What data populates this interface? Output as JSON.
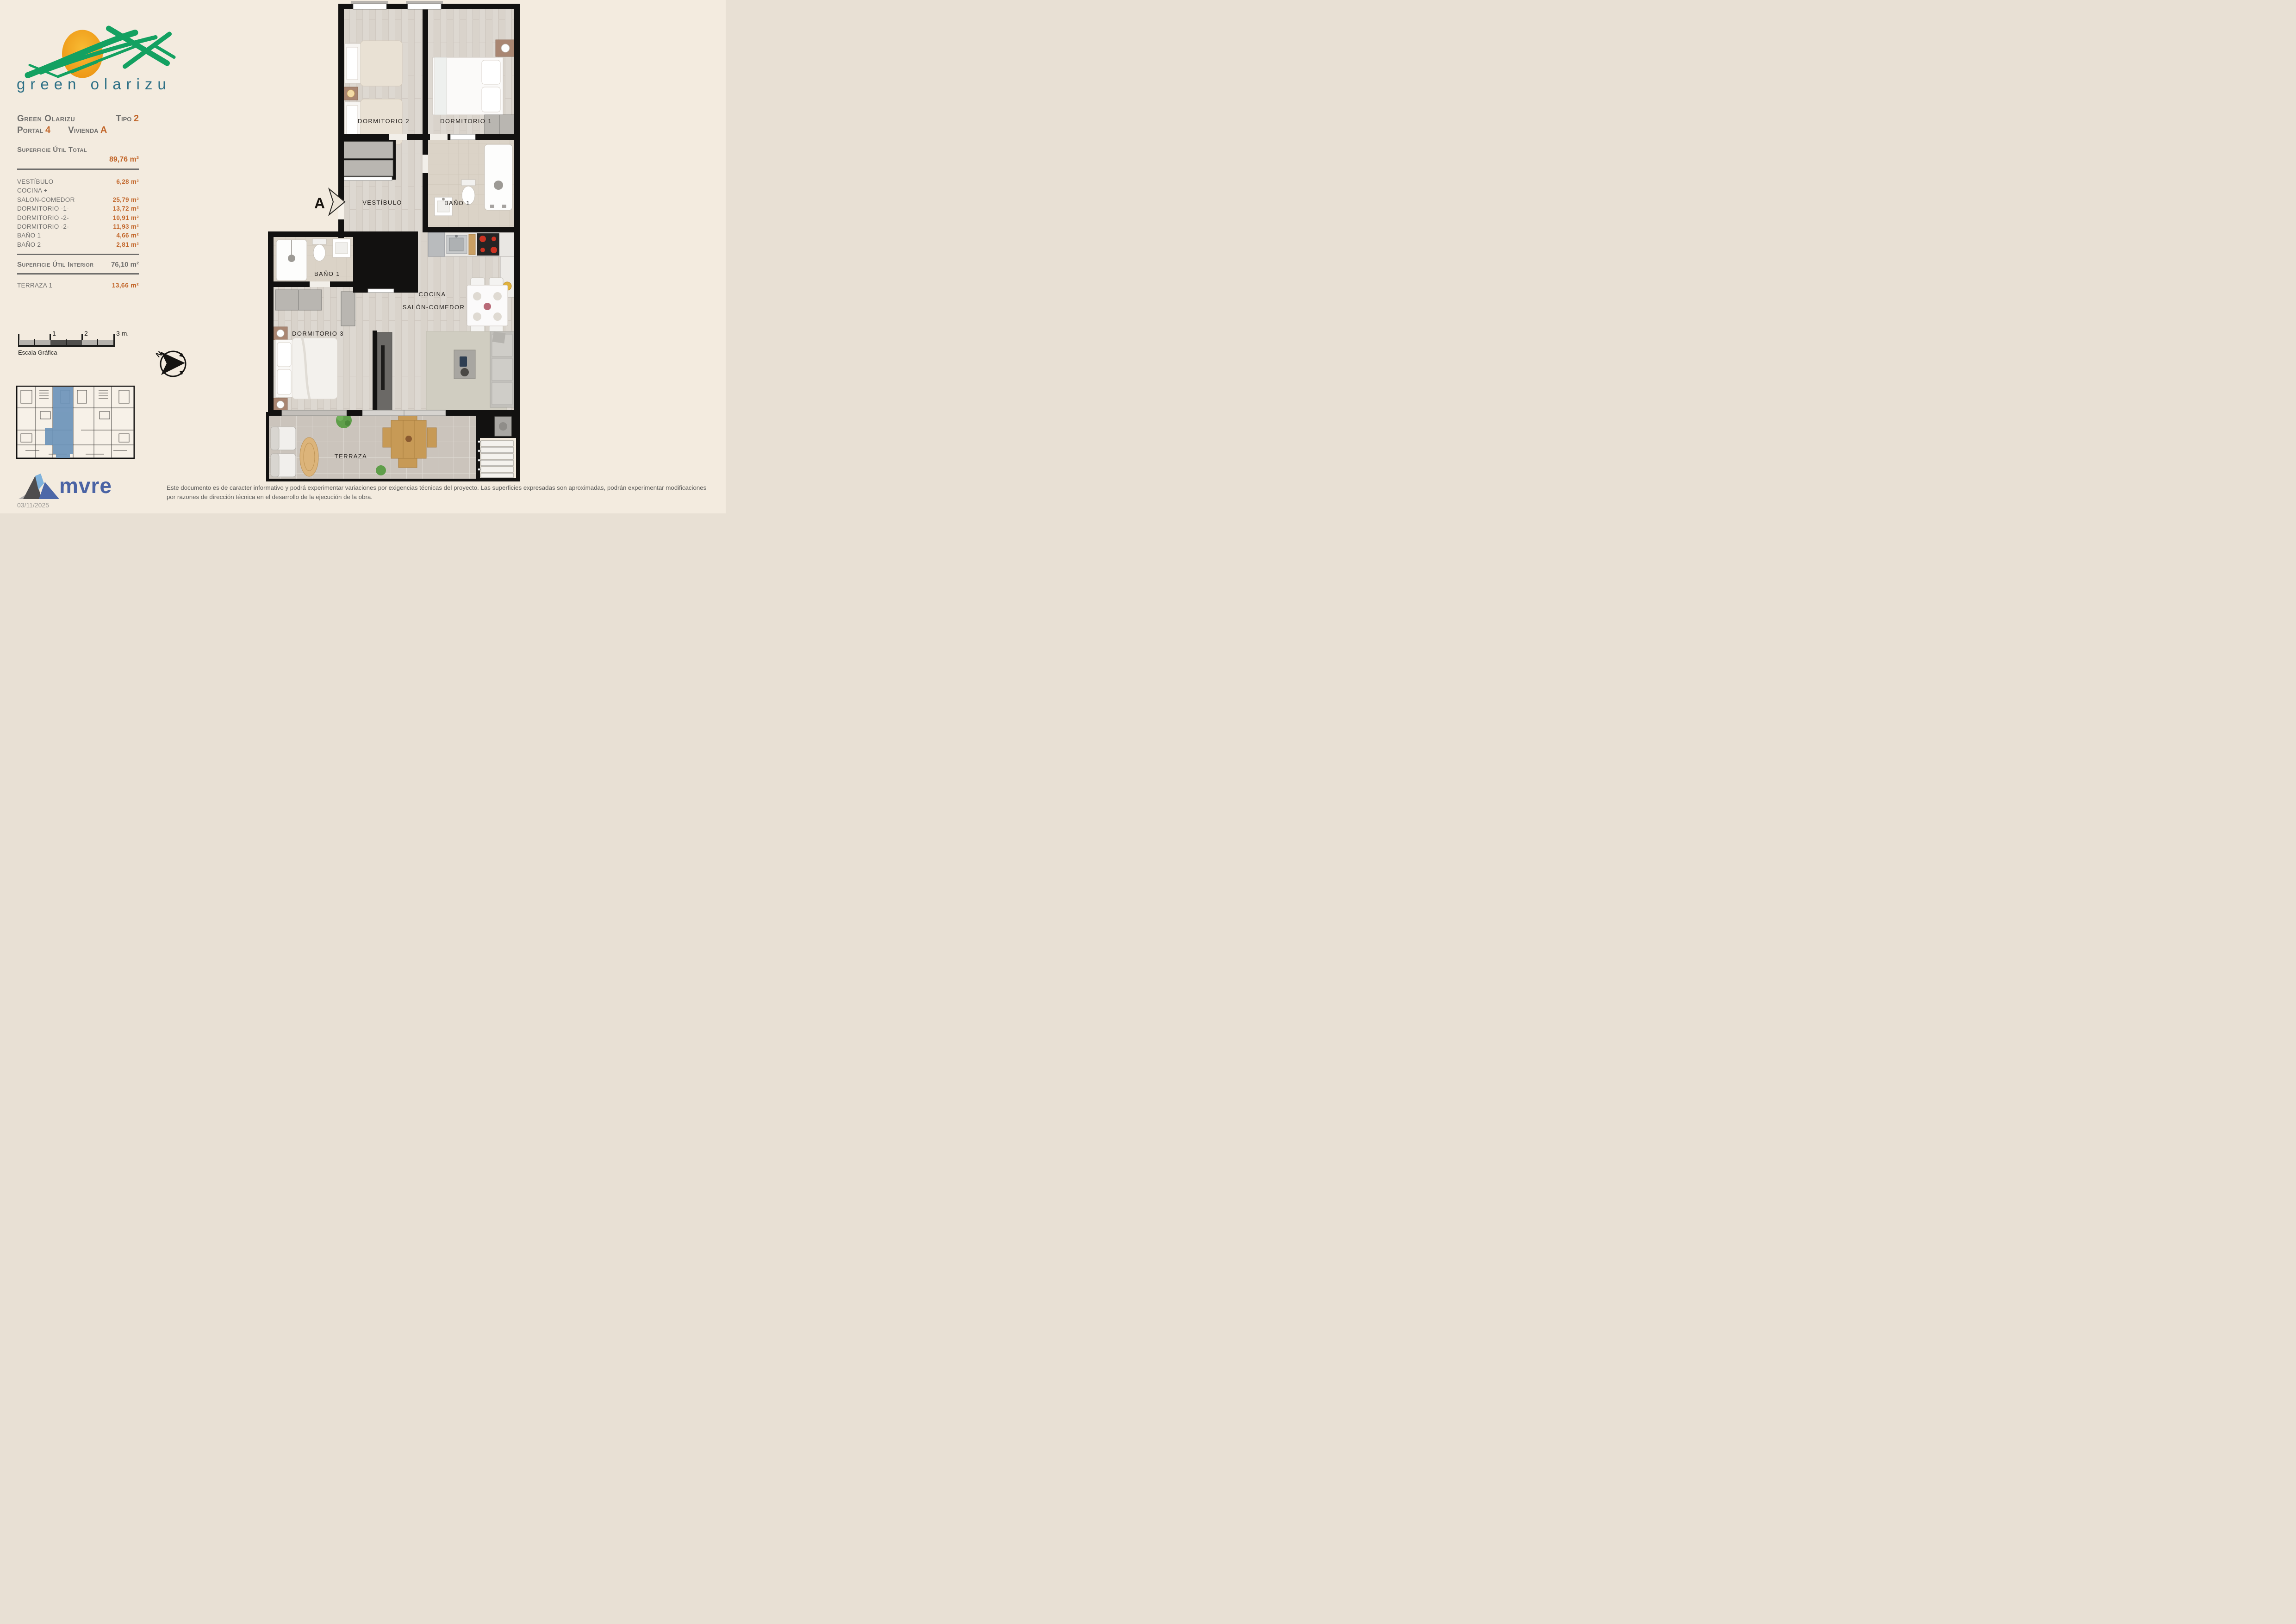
{
  "colors": {
    "paper": "#f3ebdf",
    "accent_orange": "#c2662a",
    "text_gray": "#6f6e6c",
    "logo_green": "#13a161",
    "logo_sun": "#f2a51e",
    "logo_text_teal": "#2d7086",
    "brand_blue": "#4a63a4",
    "keyplan_highlight_blue": "#6d94ba",
    "wall_black": "#121110"
  },
  "logo": {
    "brand": "green olarizu"
  },
  "info_panel": {
    "project": "Green Olarizu",
    "tipo_label": "Tipo",
    "tipo_value": "2",
    "portal_label": "Portal",
    "portal_value": "4",
    "vivienda_label": "Vivienda",
    "vivienda_value": "A",
    "total_label": "Superficie Útil Total",
    "total_value": "89,76 m²",
    "rooms": [
      {
        "name": "VESTÍBULO",
        "area": "6,28 m²"
      },
      {
        "name": "COCINA +",
        "area": ""
      },
      {
        "name": "SALON-COMEDOR",
        "area": "25,79 m²"
      },
      {
        "name": "DORMITORIO -1-",
        "area": "13,72 m²"
      },
      {
        "name": "DORMITORIO -2-",
        "area": "10,91 m²"
      },
      {
        "name": "DORMITORIO -2-",
        "area": "11,93 m²"
      },
      {
        "name": "BAÑO 1",
        "area": "4,66 m²"
      },
      {
        "name": "BAÑO 2",
        "area": "2,81 m²"
      }
    ],
    "interior_label": "Superficie Útil Interior",
    "interior_value": "76,10 m²",
    "terraza_label": "TERRAZA 1",
    "terraza_value": "13,66 m²"
  },
  "scale_bar": {
    "caption": "Escala Gráfica",
    "tick1": "1",
    "tick2": "2",
    "tick3": "3 m."
  },
  "compass": {
    "north": "N"
  },
  "floor_plan": {
    "section_marker": "A",
    "labels": {
      "dormitorio2": "DORMITORIO 2",
      "dormitorio1": "DORMITORIO 1",
      "vestibulo": "VESTÍBULO",
      "bano1": "BAÑO 1",
      "bano2": "BAÑO 1",
      "dormitorio3": "DORMITORIO 3",
      "cocina": "COCINA",
      "salon": "SALÓN-COMEDOR",
      "terraza": "TERRAZA"
    }
  },
  "footer": {
    "brand": "mvre",
    "date": "03/11/2025",
    "disclaimer": "Este documento es de caracter informativo y podrá experimentar variaciones por exigencias técnicas del proyecto. Las superficies expresadas son aproximadas, podrán experimentar modificaciones por razones de dirección técnica en el desarrollo de la ejecución de la obra."
  }
}
